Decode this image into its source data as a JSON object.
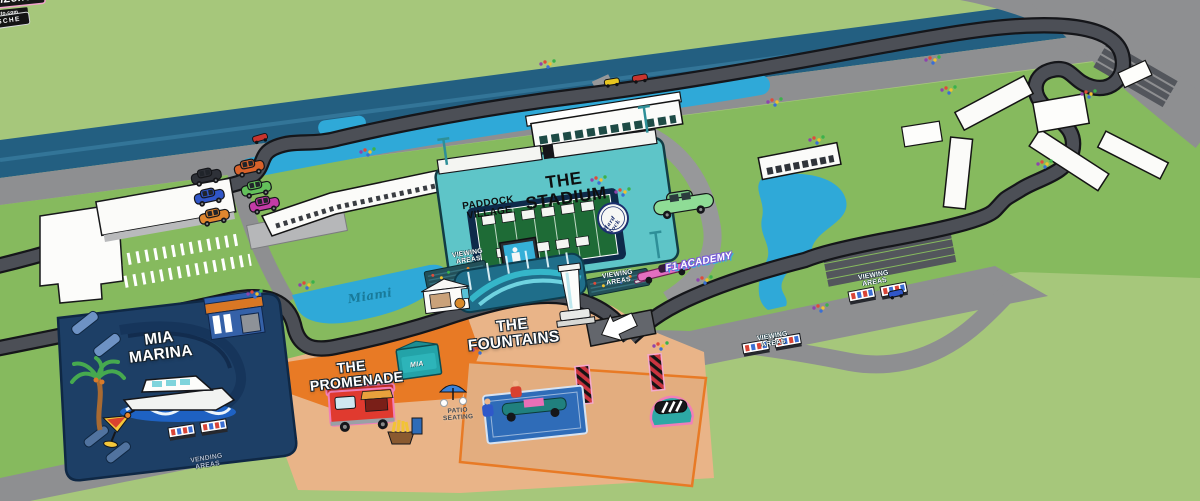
{
  "colors": {
    "background_green": "#a6c77b",
    "infield_green": "#86ba5e",
    "canal_blue": "#235f81",
    "water_cyan": "#2fa9d8",
    "road_gray": "#8e8f91",
    "track_gray": "#4c4f56",
    "stadium_teal": "#5ec5c8",
    "marina_navy": "#1d3f66",
    "promenade_orange": "#e87a25",
    "fanzone_peach": "#e9b488",
    "accent_pink": "#f06fb1"
  },
  "areas": {
    "stadium": {
      "label": "THE STADIUM"
    },
    "paddock_village": {
      "label": "PADDOCK VILLAGE"
    },
    "mia_marina": {
      "label": "MIA MARINA"
    },
    "promenade": {
      "label": "THE PROMENADE"
    },
    "fountains": {
      "label": "THE FOUNTAINS"
    },
    "fanzone": {
      "label": "FanZone",
      "f1_logo": "F1",
      "sponsor": "crypto.com"
    }
  },
  "labels": {
    "viewing_areas": "VIEWING AREAS",
    "vending_areas": "VENDING AREAS",
    "patio_seating": "PATIO SEATING",
    "miami_water_script": "Miami"
  },
  "signs": {
    "porsche": "PORSCHE",
    "f1_academy": "F1 ACADEMY",
    "hard_rock": "Hard Rock",
    "mia_shop": "MIA"
  }
}
